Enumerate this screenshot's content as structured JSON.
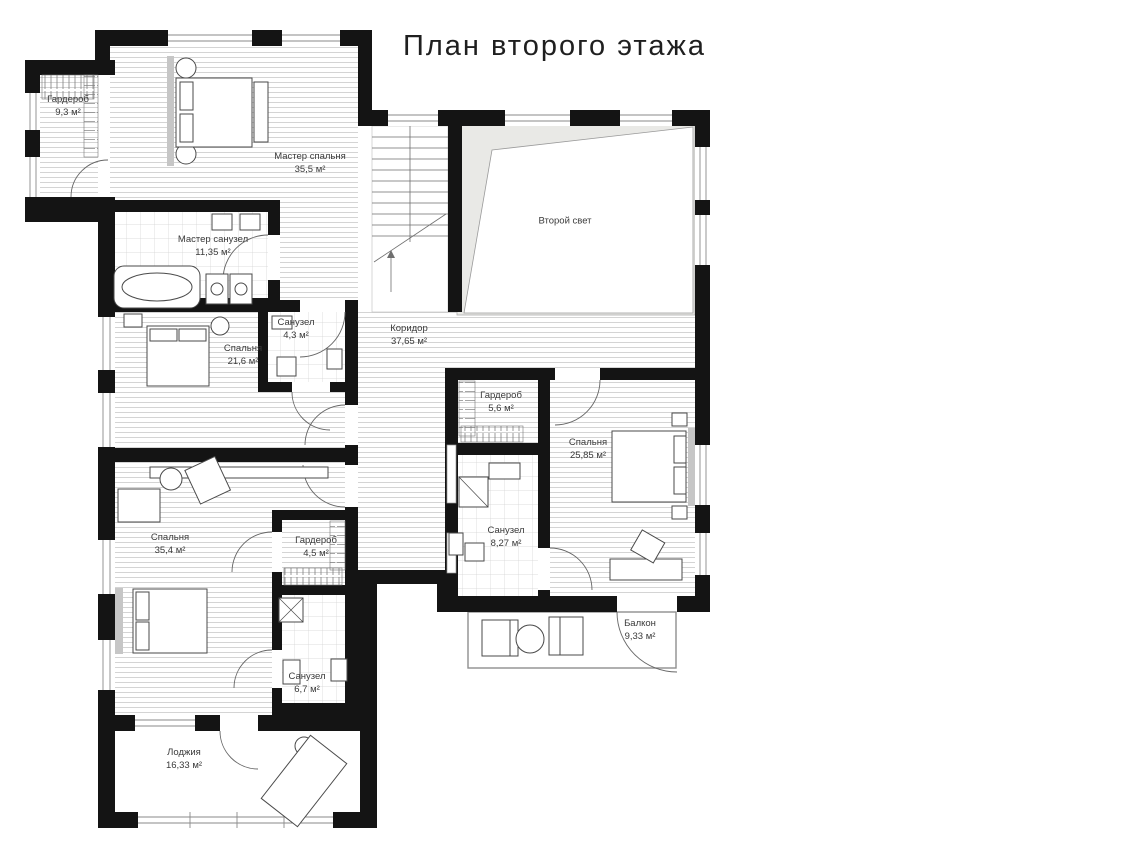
{
  "title": "План второго этажа",
  "rooms": [
    {
      "id": "wardrobe-1",
      "name": "Гардероб",
      "area": "9,3 м²"
    },
    {
      "id": "master-bedroom",
      "name": "Мастер спальня",
      "area": "35,5 м²"
    },
    {
      "id": "master-bath",
      "name": "Мастер санузел",
      "area": "11,35 м²"
    },
    {
      "id": "bedroom-2",
      "name": "Спальня",
      "area": "21,6 м²"
    },
    {
      "id": "bath-2",
      "name": "Санузел",
      "area": "4,3 м²"
    },
    {
      "id": "corridor",
      "name": "Коридор",
      "area": "37,65 м²"
    },
    {
      "id": "void",
      "name": "Второй свет",
      "area": ""
    },
    {
      "id": "wardrobe-2",
      "name": "Гардероб",
      "area": "5,6 м²"
    },
    {
      "id": "bedroom-3",
      "name": "Спальня",
      "area": "25,85 м²"
    },
    {
      "id": "bath-3",
      "name": "Санузел",
      "area": "8,27 м²"
    },
    {
      "id": "balcony",
      "name": "Балкон",
      "area": "9,33 м²"
    },
    {
      "id": "bedroom-4",
      "name": "Спальня",
      "area": "35,4 м²"
    },
    {
      "id": "wardrobe-3",
      "name": "Гардероб",
      "area": "4,5 м²"
    },
    {
      "id": "bath-4",
      "name": "Санузел",
      "area": "6,7 м²"
    },
    {
      "id": "loggia",
      "name": "Лоджия",
      "area": "16,33 м²"
    }
  ],
  "colors": {
    "wall": "#141414",
    "floor_hatch": "#c9c9c9",
    "void_fill": "#e9e9e6",
    "furniture_line": "#4a4a4a",
    "label_text": "#3a3a3a"
  }
}
